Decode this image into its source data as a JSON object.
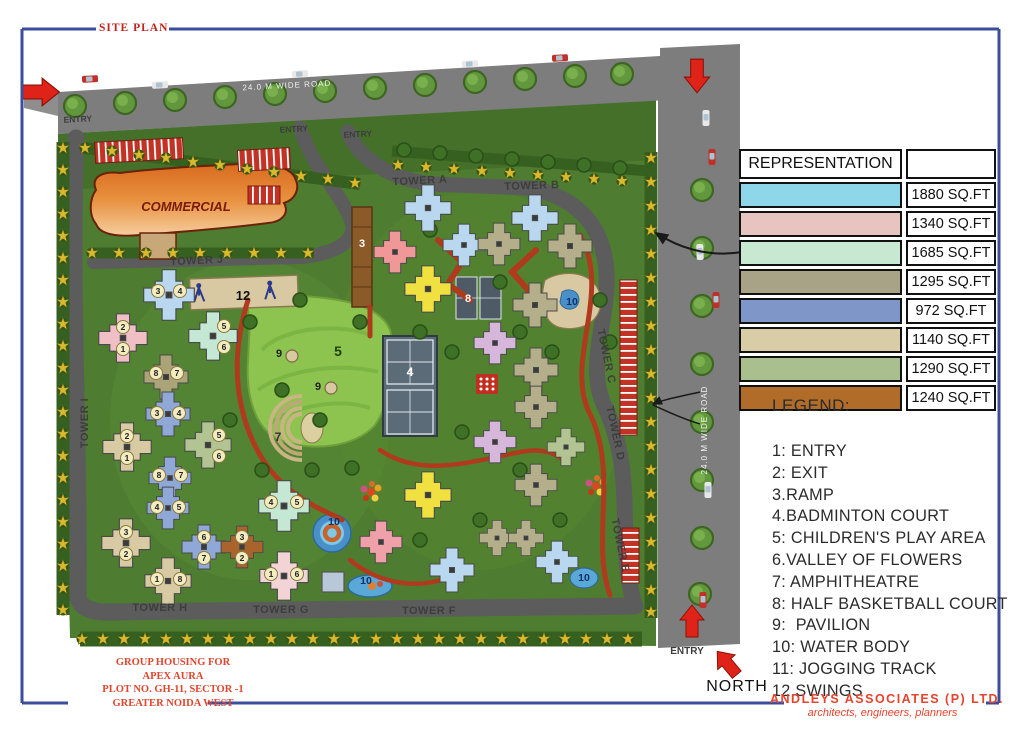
{
  "title": "SITE PLAN",
  "colors": {
    "frame": "#3A4E9C",
    "accent_red": "#D22B1F",
    "road_gray": "#7D7D7D",
    "site_green": "#4E7C31",
    "track_red": "#B03A1E"
  },
  "representation": {
    "header": "REPRESENTATION",
    "rows": [
      {
        "color": "#8ED6EA",
        "area": "1880 SQ.FT"
      },
      {
        "color": "#E7C4BF",
        "area": "1340 SQ.FT"
      },
      {
        "color": "#C9E8D1",
        "area": "1685 SQ.FT"
      },
      {
        "color": "#A8A287",
        "area": "1295 SQ.FT"
      },
      {
        "color": "#7E96C8",
        "area": "972 SQ.FT"
      },
      {
        "color": "#D9CDA7",
        "area": "1140 SQ.FT"
      },
      {
        "color": "#A9BF8E",
        "area": "1290 SQ.FT"
      },
      {
        "color": "#B26C29",
        "area": "1240 SQ.FT"
      }
    ]
  },
  "legend": {
    "title": "LEGEND:",
    "items": [
      "1: ENTRY",
      "2: EXIT",
      "3.RAMP",
      "4.BADMINTON COURT",
      "5: CHILDREN'S PLAY AREA",
      "6.VALLEY OF FLOWERS",
      "7: AMPHITHEATRE",
      "8: HALF BASKETBALL COURT",
      "9:  PAVILION",
      "10: WATER BODY",
      "11: JOGGING TRACK",
      "12.SWINGS"
    ]
  },
  "plan": {
    "road_labels": {
      "top": "24.0 M WIDE ROAD",
      "right": "24.0 M WIDE ROAD"
    },
    "entry_labels": [
      "ENTRY",
      "ENTRY",
      "ENTRY",
      "ENTRY"
    ],
    "commercial": "COMMERCIAL",
    "tower_labels": [
      "TOWER A",
      "TOWER B",
      "TOWER C",
      "TOWER D",
      "TOWER E",
      "TOWER F",
      "TOWER G",
      "TOWER H",
      "TOWER I",
      "TOWER J"
    ],
    "markers": {
      "ramp": "3",
      "badminton": "4",
      "play": "5",
      "amphitheatre": "7",
      "basketball": "8",
      "pavilion": "9",
      "water": "10",
      "swings": "12"
    },
    "towers": [
      {
        "units": [
          "3",
          "4"
        ]
      },
      {
        "units": [
          "2",
          "1"
        ]
      },
      {
        "units": [
          "5",
          "6"
        ]
      },
      {
        "units": [
          "8",
          "7"
        ]
      },
      {
        "units": [
          "3",
          "4"
        ]
      },
      {
        "units": [
          "2",
          "1"
        ]
      },
      {
        "units": [
          "5",
          "6"
        ]
      },
      {
        "units": [
          "8",
          "7"
        ]
      },
      {
        "units": [
          "4",
          "5"
        ]
      },
      {
        "units": [
          "3",
          "2"
        ]
      },
      {
        "units": [
          "6",
          "7"
        ]
      },
      {
        "units": [
          "3",
          "2"
        ]
      },
      {
        "units": [
          "1",
          "8"
        ]
      },
      {
        "units": [
          "4",
          "5"
        ]
      },
      {
        "units": [
          "1",
          "6"
        ]
      }
    ]
  },
  "compass": {
    "label": "NORTH"
  },
  "project": {
    "line1": "GROUP HOUSING FOR",
    "line2": "APEX AURA",
    "line3": "PLOT NO. GH-11, SECTOR -1",
    "line4": "GREATER NOIDA WEST"
  },
  "firm": {
    "name": "ANDLEYS ASSOCIATES (P) LTD.",
    "tagline": "architects, engineers, planners"
  }
}
